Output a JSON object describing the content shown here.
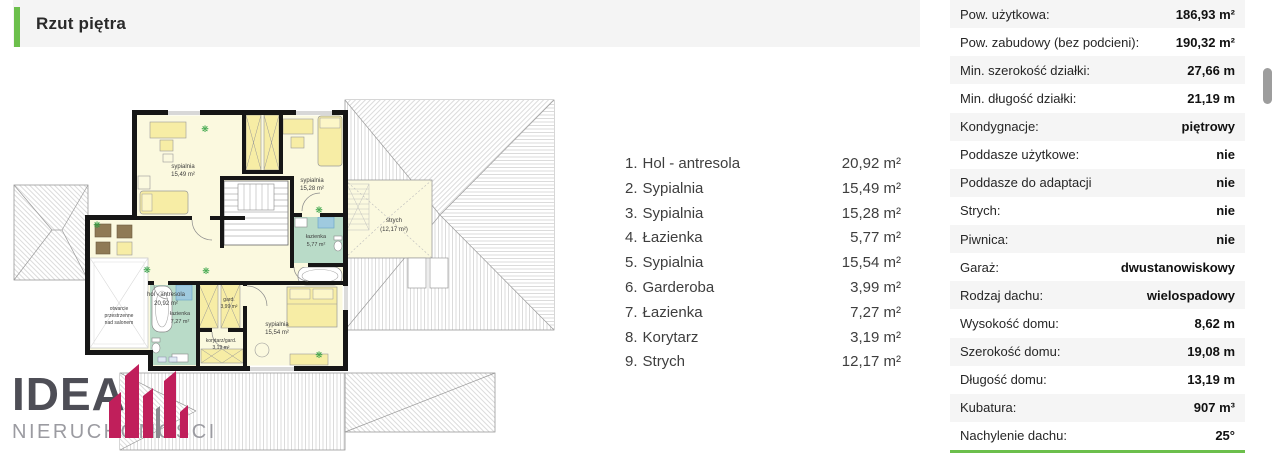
{
  "header": {
    "title": "Rzut piętra"
  },
  "colors": {
    "accent_green": "#6cbf4c",
    "logo_red": "#c01f5b"
  },
  "room_list": {
    "items": [
      {
        "num": "1.",
        "label": "Hol - antresola",
        "area": "20,92 m²"
      },
      {
        "num": "2.",
        "label": "Sypialnia",
        "area": "15,49 m²"
      },
      {
        "num": "3.",
        "label": "Sypialnia",
        "area": "15,28 m²"
      },
      {
        "num": "4.",
        "label": "Łazienka",
        "area": "5,77 m²"
      },
      {
        "num": "5.",
        "label": "Sypialnia",
        "area": "15,54 m²"
      },
      {
        "num": "6.",
        "label": "Garderoba",
        "area": "3,99 m²"
      },
      {
        "num": "7.",
        "label": "Łazienka",
        "area": "7,27 m²"
      },
      {
        "num": "8.",
        "label": "Korytarz",
        "area": "3,19 m²"
      },
      {
        "num": "9.",
        "label": "Strych",
        "area": "12,17 m²"
      }
    ]
  },
  "specs": {
    "rows": [
      {
        "label": "Pow. użytkowa:",
        "value": "186,93 m²"
      },
      {
        "label": "Pow. zabudowy (bez podcieni):",
        "value": "190,32 m²"
      },
      {
        "label": "Min. szerokość działki:",
        "value": "27,66 m"
      },
      {
        "label": "Min. długość działki:",
        "value": "21,19 m"
      },
      {
        "label": "Kondygnacje:",
        "value": "piętrowy"
      },
      {
        "label": "Poddasze użytkowe:",
        "value": "nie"
      },
      {
        "label": "Poddasze do adaptacji",
        "value": "nie"
      },
      {
        "label": "Strych:",
        "value": "nie"
      },
      {
        "label": "Piwnica:",
        "value": "nie"
      },
      {
        "label": "Garaż:",
        "value": "dwustanowiskowy"
      },
      {
        "label": "Rodzaj dachu:",
        "value": "wielospadowy"
      },
      {
        "label": "Wysokość domu:",
        "value": "8,62 m"
      },
      {
        "label": "Szerokość domu:",
        "value": "19,08 m"
      },
      {
        "label": "Długość domu:",
        "value": "13,19 m"
      },
      {
        "label": "Kubatura:",
        "value": "907 m³"
      },
      {
        "label": "Nachylenie dachu:",
        "value": "25°"
      }
    ]
  },
  "floorplan": {
    "sypialnia_a": {
      "name": "sypialnia",
      "area": "15,49 m²"
    },
    "sypialnia_b": {
      "name": "sypialnia",
      "area": "15,28 m²"
    },
    "hol": {
      "name": "hol - antresola",
      "area": "20,92 m²"
    },
    "lazienka_a": {
      "name": "łazienka",
      "area": "5,77 m²"
    },
    "strych": {
      "name": "strych",
      "area": "(12,17 m²)"
    },
    "void_l1": "otwarcie",
    "void_l2": "przestrzenne",
    "void_l3": "nad salonem",
    "lazienka_b": {
      "name": "łazienka",
      "area": "7,27 m²"
    },
    "gard": {
      "name": "gard.",
      "area": "3,99 m²"
    },
    "korytarz": {
      "name": "korytarz/gard.",
      "area": "3,19 m²"
    },
    "sypialnia_c": {
      "name": "sypialnia",
      "area": "15,54 m²"
    }
  },
  "logo": {
    "line1": "IDEA",
    "line2": "NIERUCHOMOŚCI"
  }
}
